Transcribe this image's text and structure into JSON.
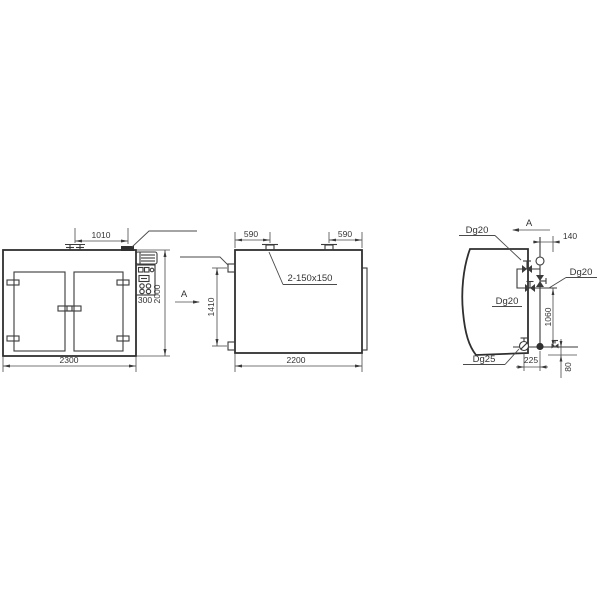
{
  "meta": {
    "background": "#ffffff",
    "line_color": "#3a3a3a",
    "text_color": "#333333",
    "drawing_type": "three-view engineering drawing of drying oven cabinet with steam piping detail"
  },
  "front_view": {
    "section_label": "A",
    "dims": {
      "vent_spacing": "1010",
      "width": "2300",
      "height": "2000",
      "control_box": "300"
    }
  },
  "side_view": {
    "vent_note": "2-150x150",
    "dims": {
      "vent_left": "590",
      "vent_right": "590",
      "width": "2200",
      "ports": "1410"
    }
  },
  "piping_view": {
    "view_label": "A",
    "labels": {
      "top": "Dg20",
      "branch": "Dg20",
      "mid": "Dg20",
      "drain": "Dg25"
    },
    "dims": {
      "offset": "140",
      "riser": "1060",
      "trap": "225",
      "bottom": "80"
    }
  }
}
